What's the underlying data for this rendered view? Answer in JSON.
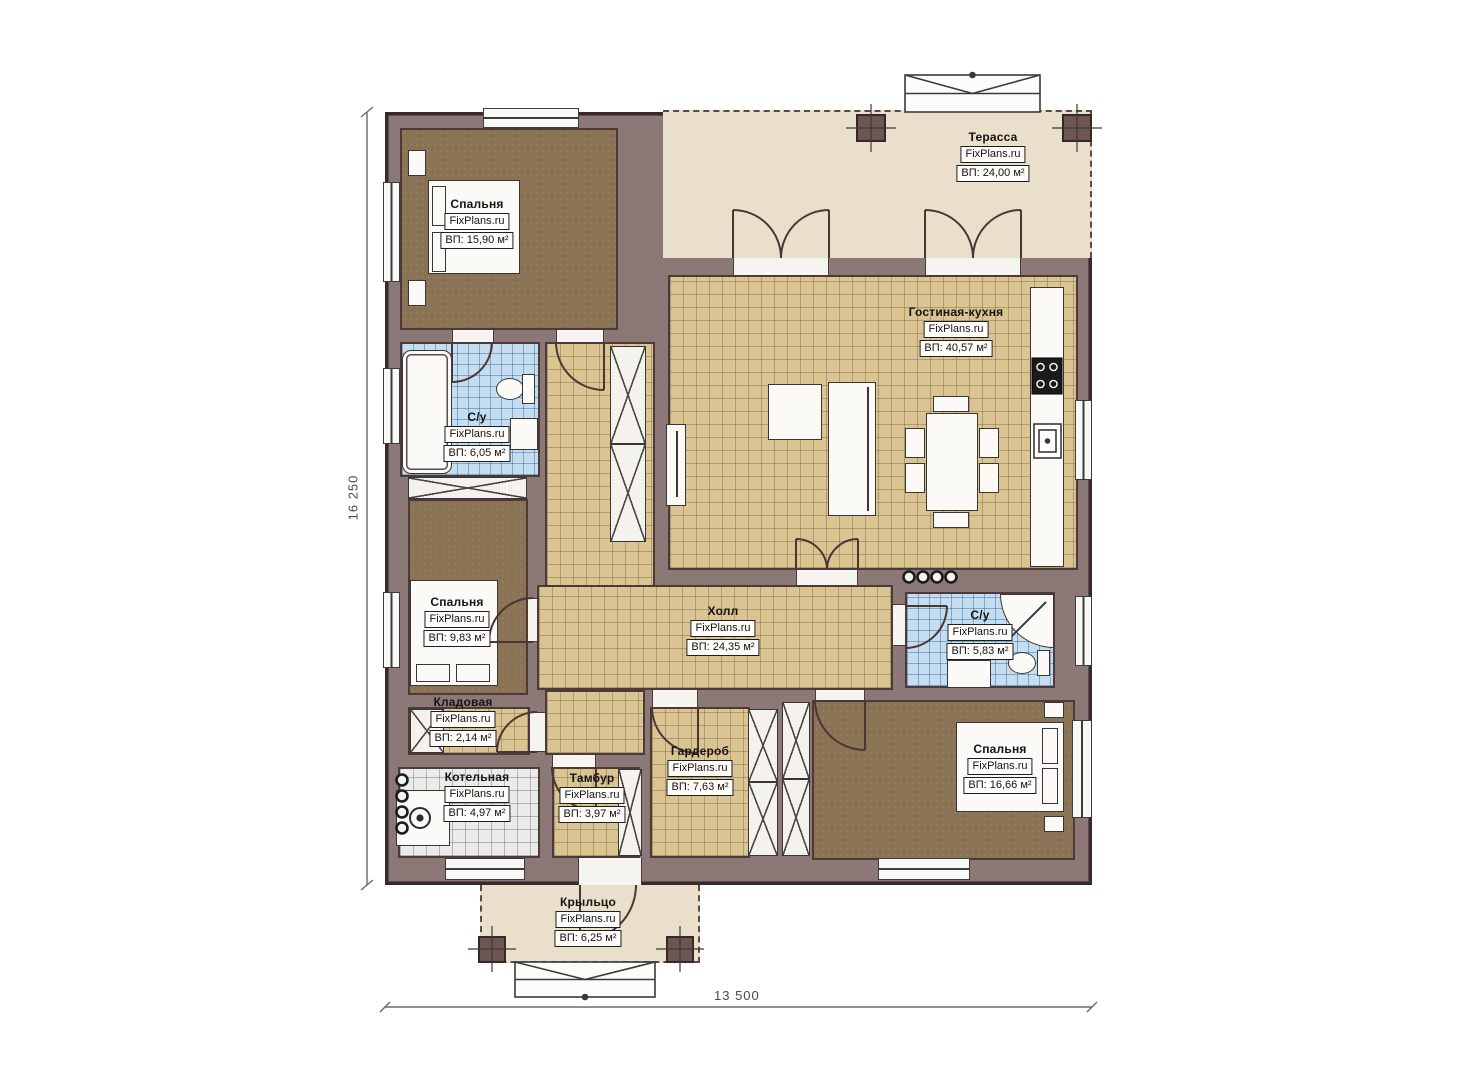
{
  "rooms": [
    {
      "name": "Спальня",
      "brand": "FixPlans.ru",
      "area": "ВП: 15,90 м²"
    },
    {
      "name": "Терасса",
      "brand": "FixPlans.ru",
      "area": "ВП: 24,00 м²"
    },
    {
      "name": "Гостиная-кухня",
      "brand": "FixPlans.ru",
      "area": "ВП: 40,57 м²"
    },
    {
      "name": "С/у",
      "brand": "FixPlans.ru",
      "area": "ВП: 6,05 м²"
    },
    {
      "name": "Спальня",
      "brand": "FixPlans.ru",
      "area": "ВП: 9,83 м²"
    },
    {
      "name": "Холл",
      "brand": "FixPlans.ru",
      "area": "ВП: 24,35 м²"
    },
    {
      "name": "С/у",
      "brand": "FixPlans.ru",
      "area": "ВП: 5,83 м²"
    },
    {
      "name": "Кладовая",
      "brand": "FixPlans.ru",
      "area": "ВП: 2,14 м²"
    },
    {
      "name": "Котельная",
      "brand": "FixPlans.ru",
      "area": "ВП: 4,97 м²"
    },
    {
      "name": "Тамбур",
      "brand": "FixPlans.ru",
      "area": "ВП: 3,97 м²"
    },
    {
      "name": "Гардероб",
      "brand": "FixPlans.ru",
      "area": "ВП: 7,63 м²"
    },
    {
      "name": "Спальня",
      "brand": "FixPlans.ru",
      "area": "ВП: 16,66 м²"
    },
    {
      "name": "Крыльцо",
      "brand": "FixPlans.ru",
      "area": "ВП: 6,25 м²"
    }
  ],
  "dimensions": {
    "left": "16 250",
    "bottom": "13 500"
  },
  "colors": {
    "wall": "#8d7878",
    "wall_edge": "#382a2a",
    "tile": "#d9c492",
    "wet_tile": "#c5ddf1",
    "wood": "#8a7254",
    "terrace": "#e9dfca"
  }
}
